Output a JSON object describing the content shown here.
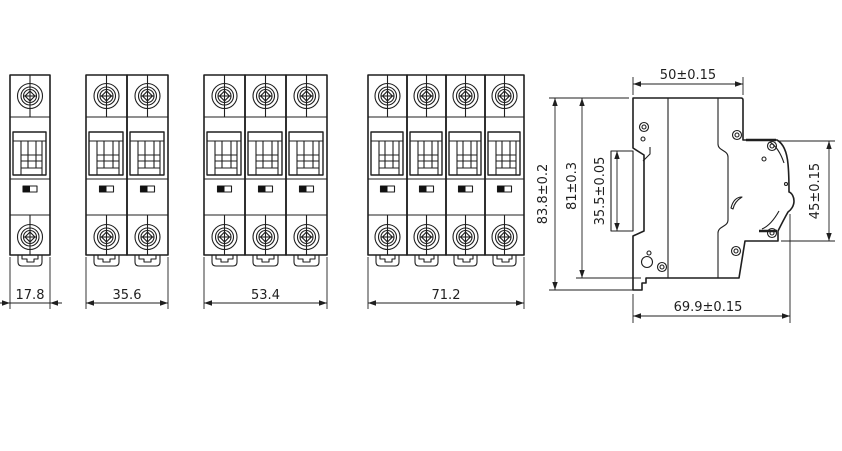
{
  "drawing": {
    "kind": "miniature-circuit-breaker dimension drawing"
  },
  "colors": {
    "line": "#1f1f1f",
    "background": "#ffffff",
    "indicator_fill": "#111111"
  },
  "front_views": [
    {
      "id": "1-pole",
      "poles": 1,
      "dim_label": "17.8"
    },
    {
      "id": "2-pole",
      "poles": 2,
      "dim_label": "35.6"
    },
    {
      "id": "3-pole",
      "poles": 3,
      "dim_label": "53.4"
    },
    {
      "id": "4-pole",
      "poles": 4,
      "dim_label": "71.2"
    }
  ],
  "side_view": {
    "labels": {
      "top_width": "50±0.15",
      "overall_height": "83.8±0.2",
      "case_height": "81±0.3",
      "din_slot_height": "35.5±0.05",
      "front_face_height": "45±0.15",
      "overall_depth": "69.9±0.15"
    }
  }
}
